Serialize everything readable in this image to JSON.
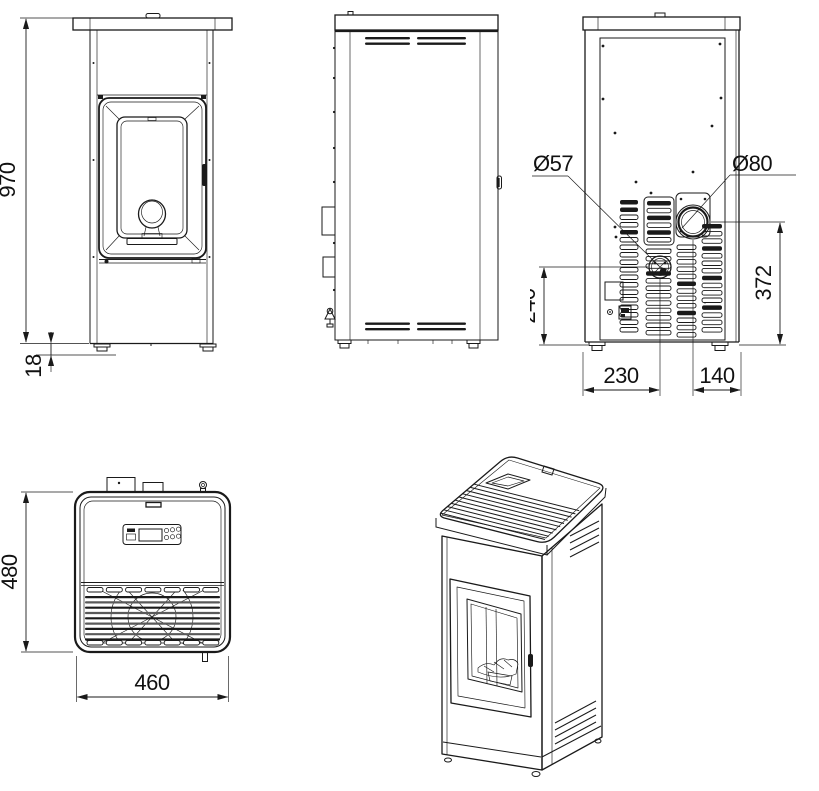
{
  "colors": {
    "line": "#1a1a1a",
    "background": "#ffffff"
  },
  "views": {
    "front": {
      "height_mm": "970",
      "plinth_mm": "18"
    },
    "back": {
      "intake_diameter": "Ø57",
      "flue_diameter": "Ø80",
      "intake_height": "240",
      "flue_height": "372",
      "intake_offset": "230",
      "flue_offset": "140"
    },
    "top": {
      "depth_mm": "480",
      "width_mm": "460"
    }
  }
}
